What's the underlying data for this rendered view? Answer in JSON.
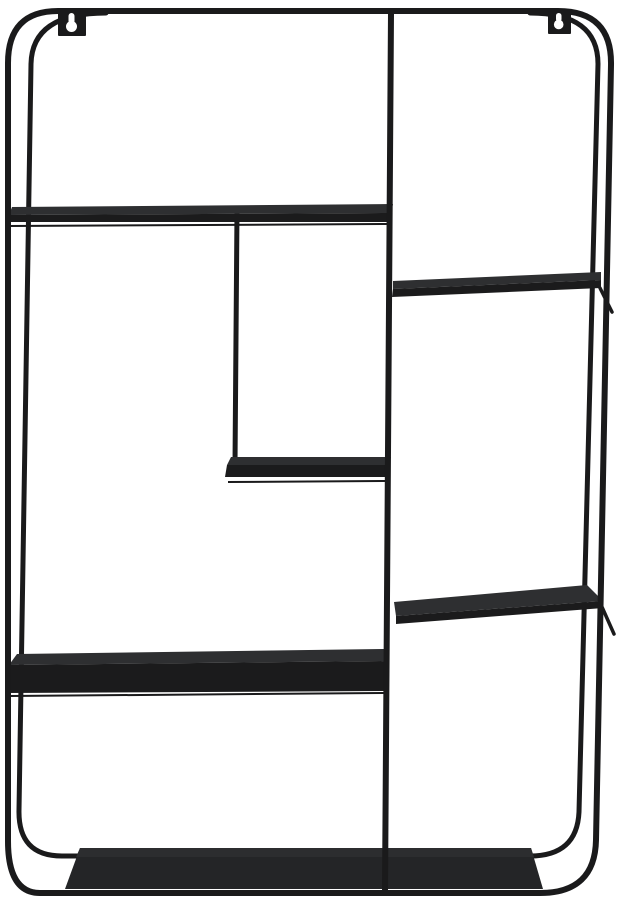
{
  "window": {
    "width": 623,
    "height": 900
  },
  "product": {
    "name": "black-metal-wall-shelf",
    "description": "Black metal wall-mounted shelf unit with a rounded rectangular wire frame, two keyhole wall hangers, a full-height vertical divider, five staggered compartment shelves and a wide deep bottom shelf",
    "finish": "matte black",
    "shelf_count": 6,
    "keyhole_mount_count": 2
  },
  "colors": {
    "background": "#ffffff",
    "metal": "#1a1a1b",
    "shelf_top": "#2e2f31",
    "shelf_front": "#1b1b1c",
    "bottom_shelf": "#242527",
    "bottom_shelf_top": "#2c2d2f",
    "keyhole_cutout": "#ffffff"
  }
}
